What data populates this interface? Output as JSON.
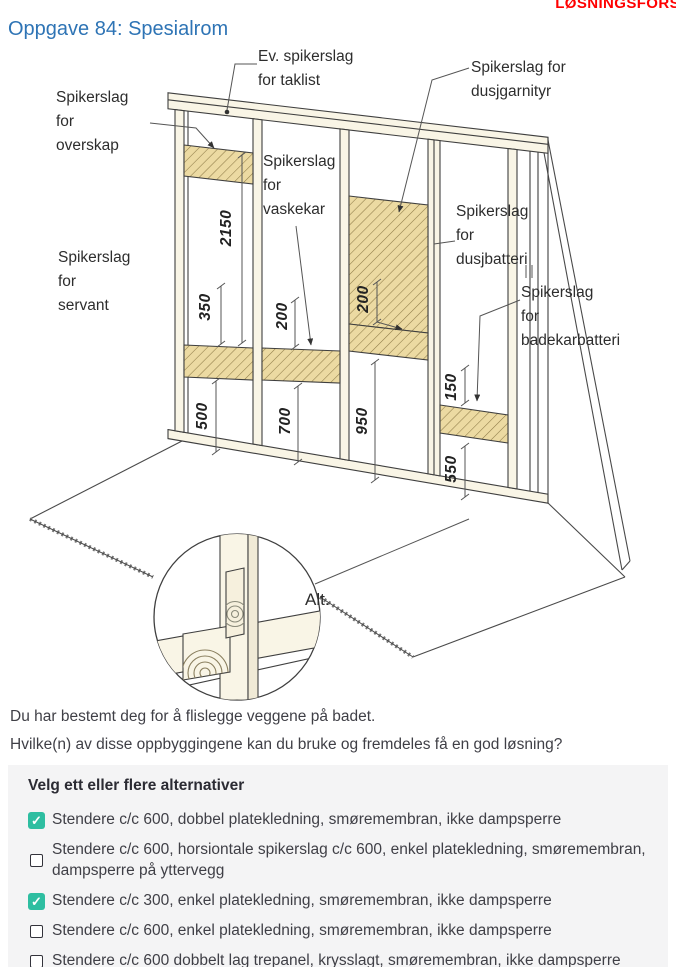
{
  "header": {
    "watermark": "LØSNINGSFORS",
    "watermark_color": "#FF0000",
    "title": "Oppgave 84: Spesialrom",
    "title_color": "#2E74B5"
  },
  "diagram": {
    "labels": {
      "overskap": "Spikerslag\nfor\noverskap",
      "taklist": "Ev. spikerslag\nfor taklist",
      "dusjgarnityr": "Spikerslag for\ndusjgarnityr",
      "vaskekar": "Spikerslag\nfor\nvaskekar",
      "dusjbatteri": "Spikerslag\nfor\ndusjbatteri",
      "badekarbatteri": "Spikerslag\nfor\nbadekarbatteri",
      "servant": "Spikerslag\nfor\nservant",
      "alt": "Alt."
    },
    "dimensions_mm": [
      "2150",
      "350",
      "500",
      "200",
      "700",
      "200",
      "950",
      "150",
      "550"
    ],
    "hatch_fill": "#ECDAA2",
    "wood_fill": "#F9F5E6"
  },
  "question": {
    "line1": "Du har bestemt deg for å flislegge veggene på badet.",
    "line2": "Hvilke(n) av disse oppbyggingene kan du bruke og fremdeles få en god løsning?"
  },
  "options": {
    "heading": "Velg ett eller flere alternativer",
    "checked_color": "#2EBEA1",
    "panel_background": "#F4F4F5",
    "items": [
      {
        "label": "Stendere c/c 600, dobbel platekledning, smøremembran, ikke dampsperre",
        "checked": true
      },
      {
        "label": "Stendere c/c 600, horsiontale spikerslag c/c 600, enkel platekledning, smøremembran, dampsperre på yttervegg",
        "checked": false
      },
      {
        "label": "Stendere c/c 300, enkel platekledning, smøremembran, ikke dampsperre",
        "checked": true
      },
      {
        "label": "Stendere c/c 600, enkel platekledning, smøremembran, ikke dampsperre",
        "checked": false
      },
      {
        "label": "Stendere c/c 600 dobbelt lag trepanel, krysslagt, smøremembran, ikke dampsperre",
        "checked": false
      }
    ]
  }
}
